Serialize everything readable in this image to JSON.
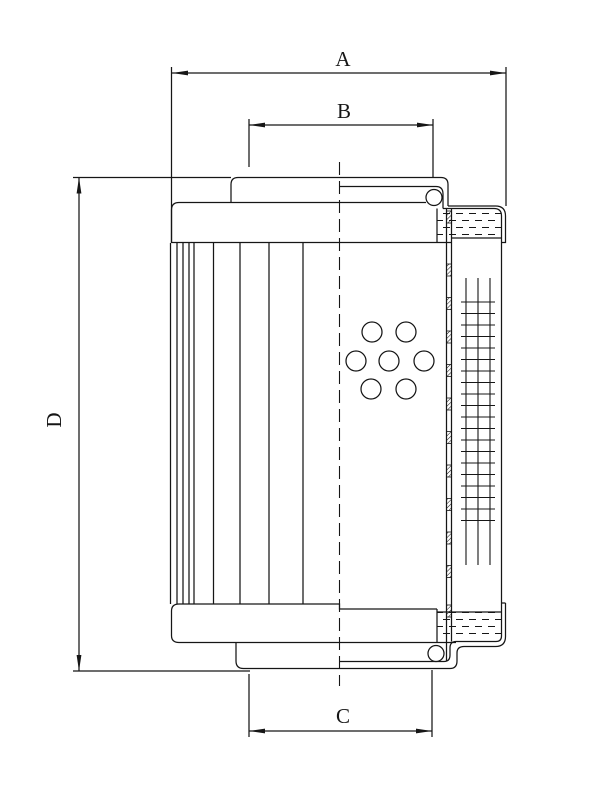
{
  "drawing": {
    "name": "filter-element-cross-section",
    "canvas": {
      "width": 612,
      "height": 792,
      "background": "#ffffff",
      "line_color": "#161616",
      "line_width": 1.25
    },
    "dimension_labels": {
      "a": "A",
      "b": "B",
      "c": "C",
      "d": "D"
    },
    "dimensions": [
      {
        "id": "A",
        "label": "A",
        "orientation": "horizontal",
        "line_y": 73,
        "from": 172,
        "to": 506,
        "label_x": 343,
        "label_y": 66,
        "extensions": [
          {
            "x": 171.5,
            "y1": 67,
            "y2": 243
          },
          {
            "x": 506,
            "y1": 67,
            "y2": 206
          }
        ]
      },
      {
        "id": "B",
        "label": "B",
        "orientation": "horizontal",
        "line_y": 125,
        "from": 249,
        "to": 433,
        "label_x": 344,
        "label_y": 118,
        "extensions": [
          {
            "x": 249,
            "y1": 119,
            "y2": 167
          },
          {
            "x": 433,
            "y1": 119,
            "y2": 177.5
          }
        ]
      },
      {
        "id": "C",
        "label": "C",
        "orientation": "horizontal",
        "line_y": 731,
        "from": 249,
        "to": 432,
        "label_x": 343,
        "label_y": 723,
        "extensions": [
          {
            "x": 249,
            "y1": 674,
            "y2": 737
          },
          {
            "x": 432,
            "y1": 670,
            "y2": 737
          }
        ]
      },
      {
        "id": "D",
        "label": "D",
        "orientation": "vertical",
        "line_x": 79,
        "from": 177.5,
        "to": 671,
        "label_x": 61,
        "label_y": 420,
        "extensions": [
          {
            "y": 177.5,
            "x1": 73,
            "x2": 231
          },
          {
            "y": 671,
            "x1": 73,
            "x2": 250
          }
        ]
      }
    ],
    "arrow": {
      "length": 16,
      "half_width": 2.4
    },
    "label_font_size": 21,
    "centerline": {
      "x": 339.5,
      "y1": 162,
      "y2": 686,
      "dash": "13 6"
    },
    "pleat_lines": {
      "xs": [
        170.5,
        177,
        183,
        189,
        194,
        213.5,
        240,
        269,
        303
      ],
      "y1": 243,
      "y2": 604
    },
    "perforations": {
      "radius": 10,
      "centers": [
        [
          372,
          332
        ],
        [
          406,
          332
        ],
        [
          356,
          361
        ],
        [
          389,
          361
        ],
        [
          424,
          361
        ],
        [
          371,
          389
        ],
        [
          406,
          389
        ]
      ]
    },
    "support_mesh": {
      "vertical_xs": [
        466,
        478,
        490
      ],
      "v_y1": 278,
      "v_y2": 565,
      "h_x1": 461,
      "h_x2": 495,
      "h_y_start": 302,
      "h_y_end": 520.5,
      "h_count": 20
    },
    "media_strip": {
      "x1": 446.5,
      "x2": 451.5,
      "y1_left": 209,
      "y2_left": 661.5,
      "y1_right": 209,
      "y2_right": 641.5,
      "block_h": 12,
      "block_ys": [
        211,
        264,
        297.5,
        331,
        364.5,
        398,
        431.5,
        465,
        498.5,
        532,
        565.5,
        605
      ]
    },
    "adhesive_regions": [
      {
        "x": 437,
        "y": 210,
        "w": 64.5,
        "h": 28
      },
      {
        "x": 437,
        "y": 612,
        "w": 64.5,
        "h": 28
      }
    ],
    "o_rings": [
      {
        "cx": 434,
        "cy": 197.5,
        "r": 8
      },
      {
        "cx": 436,
        "cy": 653.5,
        "r": 8
      }
    ],
    "outline_paths": [
      {
        "name": "top-cap-body",
        "d": "M 171.5,243 L 171.5,210 Q 171.5,202.5 179,202.5 L 426,202.5"
      },
      {
        "name": "top-cap-bottom-edge",
        "d": "M 171.5,242.5 L 451.5,242.5"
      },
      {
        "name": "top-cap-right-face",
        "d": "M 437,208.5 L 437,242.5"
      },
      {
        "name": "top-tube-outer",
        "d": "M 231,202.5 L 231,184.5 Q 231,177.5 238,177.5 L 441,177.5 Q 448,177.5 448,184.5 L 448,206"
      },
      {
        "name": "top-tube-inner",
        "d": "M 339.5,186.5 L 436,186.5 Q 443,186.5 443,194 L 443,208.5"
      },
      {
        "name": "top-skirt-outer",
        "d": "M 448,206 L 495.5,206 Q 505.5,206 505.5,216 L 505.5,242.5 L 501.5,242.5"
      },
      {
        "name": "top-skirt-inner",
        "d": "M 443,208.5 L 494,208.5 Q 501.5,208.5 501.5,216"
      },
      {
        "name": "adhesive-top-bottom-edge",
        "d": "M 451.5,238 L 501.5,238"
      },
      {
        "name": "shell-inner-wall",
        "d": "M 501.5,216 L 501.5,636 Q 501.5,641.5 496,641.5 L 456,641.5 Q 450,641.5 450,648 L 450,655 Q 450,661.5 444,661.5 L 339.5,661.5"
      },
      {
        "name": "shell-outer-skirt",
        "d": "M 505.5,603 L 505.5,636.5 Q 505.5,646.5 495.5,646.5 L 464,646.5 Q 457,646.5 457,653 L 457,661 Q 457,668.5 450,668.5 L 243.5,668.5"
      },
      {
        "name": "cup-top-tick",
        "d": "M 501.5,603 L 505.5,603"
      },
      {
        "name": "bottom-cap-top-edge",
        "d": "M 171.5,611 Q 171.5,604 179,604 L 339.5,604 L 339.5,609 L 437,609"
      },
      {
        "name": "bottom-cap-left-bottom",
        "d": "M 171.5,611 L 171.5,635.5 Q 171.5,642.5 179,642.5 L 456,642.5"
      },
      {
        "name": "bottom-cap-right-face",
        "d": "M 437,609 L 437,642.5"
      },
      {
        "name": "adhesive-bottom-top-edge",
        "d": "M 437,612 L 501.5,612"
      },
      {
        "name": "spigot-left-edge",
        "d": "M 236,642.5 L 236,661 Q 236,668.5 243.5,668.5"
      }
    ]
  }
}
